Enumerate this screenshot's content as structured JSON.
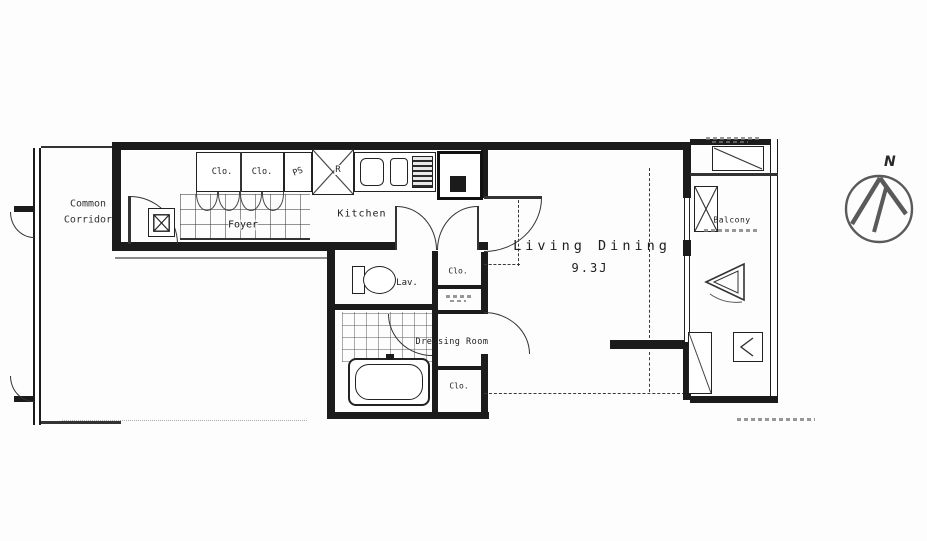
{
  "colors": {
    "wall": "#1b1b1b",
    "line": "#333333",
    "background": "#fdfdfd",
    "text": "#1d1d1d"
  },
  "labels": {
    "common_corridor_line1": "Common",
    "common_corridor_line2": "Corridor",
    "closet": "Clo.",
    "pipe_space": "PS",
    "refrigerator": "R",
    "foyer": "Foyer",
    "kitchen": "Kitchen",
    "lavatory": "Lav.",
    "dressing_room": "Dressing Room",
    "living_dining": "Living Dining",
    "living_dining_size": "9.3J",
    "balcony": "Balcony",
    "compass_north": "N"
  }
}
